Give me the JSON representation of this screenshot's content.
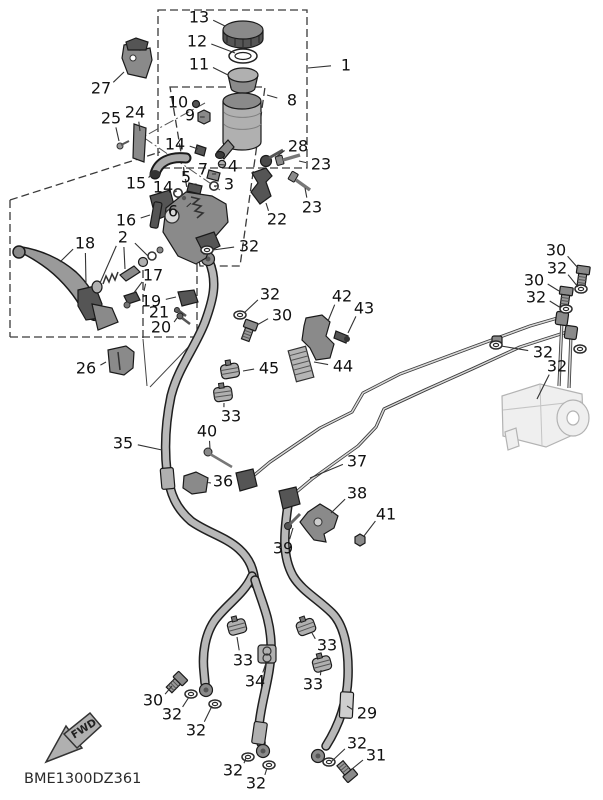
{
  "diagram": {
    "code": "BME1300DZ361",
    "fwd_label": "FWD",
    "colors": {
      "background": "#ffffff",
      "line": "#1a1a1a",
      "label": "#111111",
      "hose": "#b8b8b8",
      "phantom": "#b3b3b3"
    },
    "labels": [
      {
        "part": "13",
        "x": 199,
        "y": 17,
        "leads": [
          [
            225,
            26
          ]
        ]
      },
      {
        "part": "12",
        "x": 197,
        "y": 41,
        "leads": [
          [
            235,
            53
          ]
        ]
      },
      {
        "part": "11",
        "x": 199,
        "y": 64,
        "leads": [
          [
            228,
            75
          ]
        ]
      },
      {
        "part": "1",
        "x": 346,
        "y": 65,
        "leads": [
          [
            308,
            68
          ]
        ]
      },
      {
        "part": "27",
        "x": 101,
        "y": 88,
        "leads": [
          [
            124,
            72
          ]
        ]
      },
      {
        "part": "8",
        "x": 292,
        "y": 100,
        "leads": [
          [
            267,
            95
          ]
        ]
      },
      {
        "part": "10",
        "x": 178,
        "y": 102,
        "leads": [
          [
            193,
            105
          ]
        ]
      },
      {
        "part": "24",
        "x": 135,
        "y": 112,
        "leads": [
          [
            140,
            131
          ]
        ]
      },
      {
        "part": "9",
        "x": 190,
        "y": 115,
        "leads": [
          [
            200,
            117
          ]
        ]
      },
      {
        "part": "25",
        "x": 111,
        "y": 118,
        "leads": [
          [
            119,
            141
          ]
        ]
      },
      {
        "part": "14",
        "x": 175,
        "y": 144,
        "leads": [
          [
            198,
            149
          ]
        ]
      },
      {
        "part": "28",
        "x": 298,
        "y": 146,
        "leads": [
          [
            276,
            157
          ]
        ]
      },
      {
        "part": "23",
        "x": 321,
        "y": 164,
        "leads": [
          [
            299,
            161
          ]
        ]
      },
      {
        "part": "4",
        "x": 233,
        "y": 166,
        "leads": [
          [
            226,
            165
          ]
        ]
      },
      {
        "part": "7",
        "x": 203,
        "y": 169,
        "leads": [
          [
            212,
            174
          ]
        ]
      },
      {
        "part": "5",
        "x": 186,
        "y": 177,
        "leads": [
          [
            193,
            184
          ]
        ]
      },
      {
        "part": "15",
        "x": 136,
        "y": 183,
        "leads": [
          [
            153,
            172
          ]
        ]
      },
      {
        "part": "3",
        "x": 229,
        "y": 184,
        "leads": [
          [
            218,
            186
          ]
        ]
      },
      {
        "part": "14",
        "x": 163,
        "y": 187,
        "leads": [
          [
            175,
            192
          ]
        ]
      },
      {
        "part": "23",
        "x": 312,
        "y": 207,
        "leads": [
          [
            305,
            188
          ]
        ]
      },
      {
        "part": "6",
        "x": 173,
        "y": 211,
        "leads": [
          [
            191,
            203
          ]
        ]
      },
      {
        "part": "22",
        "x": 277,
        "y": 219,
        "leads": [
          [
            266,
            203
          ]
        ]
      },
      {
        "part": "16",
        "x": 126,
        "y": 220,
        "leads": [
          [
            150,
            215
          ]
        ]
      },
      {
        "part": "2",
        "x": 123,
        "y": 237,
        "leads": [
          [
            100,
            283
          ],
          [
            125,
            269
          ],
          [
            148,
            256
          ]
        ]
      },
      {
        "part": "18",
        "x": 85,
        "y": 243,
        "leads": [
          [
            60,
            262
          ],
          [
            86,
            284
          ]
        ]
      },
      {
        "part": "32",
        "x": 249,
        "y": 246,
        "leads": [
          [
            213,
            250
          ]
        ]
      },
      {
        "part": "17",
        "x": 153,
        "y": 275,
        "leads": [
          [
            133,
            294
          ],
          [
            144,
            291
          ]
        ]
      },
      {
        "part": "32",
        "x": 270,
        "y": 294,
        "leads": [
          [
            244,
            313
          ]
        ]
      },
      {
        "part": "19",
        "x": 151,
        "y": 301,
        "leads": [
          [
            176,
            297
          ]
        ]
      },
      {
        "part": "21",
        "x": 159,
        "y": 312,
        "leads": [
          [
            175,
            311
          ]
        ]
      },
      {
        "part": "30",
        "x": 282,
        "y": 315,
        "leads": [
          [
            257,
            325
          ]
        ]
      },
      {
        "part": "20",
        "x": 161,
        "y": 327,
        "leads": [
          [
            177,
            318
          ]
        ]
      },
      {
        "part": "42",
        "x": 342,
        "y": 296,
        "leads": [
          [
            328,
            321
          ]
        ]
      },
      {
        "part": "43",
        "x": 364,
        "y": 308,
        "leads": [
          [
            348,
            333
          ]
        ]
      },
      {
        "part": "30",
        "x": 556,
        "y": 250,
        "leads": [
          [
            578,
            268
          ]
        ]
      },
      {
        "part": "32",
        "x": 557,
        "y": 268,
        "leads": [
          [
            578,
            287
          ]
        ]
      },
      {
        "part": "30",
        "x": 534,
        "y": 280,
        "leads": [
          [
            559,
            291
          ]
        ]
      },
      {
        "part": "32",
        "x": 536,
        "y": 297,
        "leads": [
          [
            561,
            308
          ]
        ]
      },
      {
        "part": "32",
        "x": 543,
        "y": 352,
        "leads": [
          [
            501,
            346
          ]
        ]
      },
      {
        "part": "32",
        "x": 557,
        "y": 366,
        "leads": [
          [
            537,
            399
          ]
        ]
      },
      {
        "part": "44",
        "x": 343,
        "y": 366,
        "leads": [
          [
            314,
            362
          ]
        ]
      },
      {
        "part": "45",
        "x": 269,
        "y": 368,
        "leads": [
          [
            243,
            371
          ]
        ]
      },
      {
        "part": "26",
        "x": 86,
        "y": 368,
        "leads": [
          [
            106,
            362
          ]
        ]
      },
      {
        "part": "33",
        "x": 231,
        "y": 416,
        "leads": [
          [
            224,
            403
          ]
        ]
      },
      {
        "part": "40",
        "x": 207,
        "y": 431,
        "leads": [
          [
            210,
            449
          ]
        ]
      },
      {
        "part": "35",
        "x": 123,
        "y": 443,
        "leads": [
          [
            162,
            450
          ]
        ]
      },
      {
        "part": "37",
        "x": 357,
        "y": 461,
        "leads": [
          [
            310,
            478
          ]
        ]
      },
      {
        "part": "36",
        "x": 223,
        "y": 481,
        "leads": [
          [
            211,
            483
          ]
        ]
      },
      {
        "part": "38",
        "x": 357,
        "y": 493,
        "leads": [
          [
            331,
            513
          ]
        ]
      },
      {
        "part": "41",
        "x": 386,
        "y": 514,
        "leads": [
          [
            364,
            536
          ]
        ]
      },
      {
        "part": "39",
        "x": 283,
        "y": 548,
        "leads": [
          [
            293,
            528
          ]
        ]
      },
      {
        "part": "33",
        "x": 243,
        "y": 660,
        "leads": [
          [
            237,
            637
          ]
        ]
      },
      {
        "part": "33",
        "x": 327,
        "y": 645,
        "leads": [
          [
            312,
            633
          ]
        ]
      },
      {
        "part": "34",
        "x": 255,
        "y": 681,
        "leads": [
          [
            266,
            663
          ]
        ]
      },
      {
        "part": "33",
        "x": 313,
        "y": 684,
        "leads": [
          [
            321,
            670
          ]
        ]
      },
      {
        "part": "30",
        "x": 153,
        "y": 700,
        "leads": [
          [
            172,
            686
          ]
        ]
      },
      {
        "part": "29",
        "x": 367,
        "y": 713,
        "leads": [
          [
            347,
            706
          ]
        ]
      },
      {
        "part": "32",
        "x": 172,
        "y": 714,
        "leads": [
          [
            189,
            697
          ]
        ]
      },
      {
        "part": "32",
        "x": 196,
        "y": 730,
        "leads": [
          [
            212,
            706
          ]
        ]
      },
      {
        "part": "32",
        "x": 357,
        "y": 743,
        "leads": [
          [
            331,
            762
          ]
        ]
      },
      {
        "part": "31",
        "x": 376,
        "y": 755,
        "leads": [
          [
            352,
            769
          ]
        ]
      },
      {
        "part": "32",
        "x": 233,
        "y": 770,
        "leads": [
          [
            246,
            758
          ]
        ]
      },
      {
        "part": "32",
        "x": 256,
        "y": 783,
        "leads": [
          [
            267,
            768
          ]
        ]
      }
    ]
  }
}
